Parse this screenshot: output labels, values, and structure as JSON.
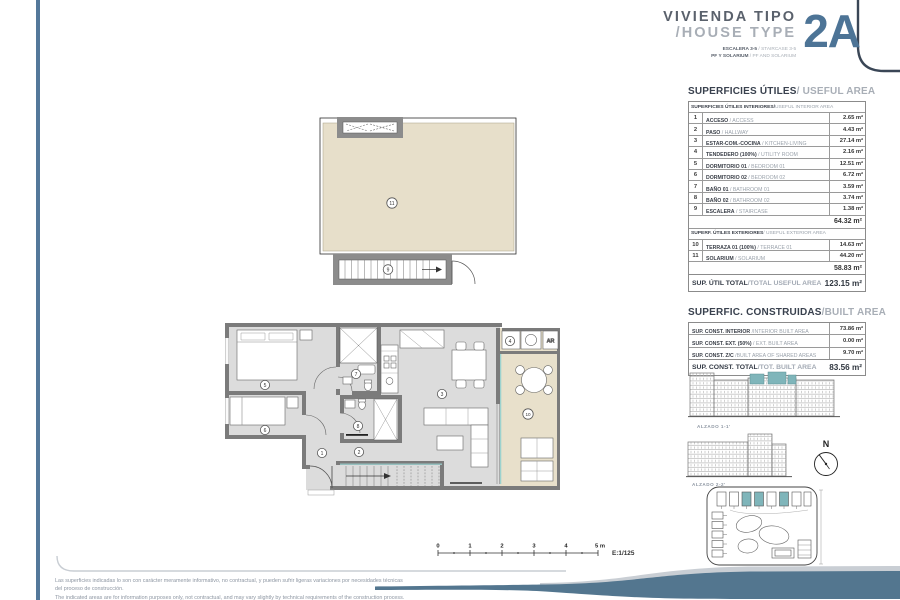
{
  "header": {
    "title_es": "VIVIENDA TIPO",
    "title_en": "/HOUSE TYPE",
    "code": "2A",
    "sub1_es": "ESCALERA 3-5",
    "sub1_en": " / STAIRCASE 3-5",
    "sub2_es": "PF Y SOLARIUM",
    "sub2_en": " / PF AND SOLARIUM"
  },
  "useful": {
    "title_es": "SUPERFICIES ÚTILES",
    "title_en": " / USEFUL AREA",
    "int_header_es": "SUPERFICIES ÚTILES INTERIORES/",
    "int_header_en": " USEFUL INTERIOR AREA",
    "rows": [
      {
        "num": "1",
        "es": "ACCESO",
        "en": " / ACCESS",
        "val": "2.65 m²"
      },
      {
        "num": "2",
        "es": "PASO",
        "en": " / HALLWAY",
        "val": "4.43 m²"
      },
      {
        "num": "3",
        "es": "ESTAR-COM.-COCINA",
        "en": " / KITCHEN-LIVING",
        "val": "27.14 m²"
      },
      {
        "num": "4",
        "es": "TENDEDERO (100%)",
        "en": " / UTILITY ROOM",
        "val": "2.16 m²"
      },
      {
        "num": "5",
        "es": "DORMITORIO 01",
        "en": " / BEDROOM 01",
        "val": "12.51 m²"
      },
      {
        "num": "6",
        "es": "DORMITORIO 02",
        "en": " / BEDROOM 02",
        "val": "6.72 m²"
      },
      {
        "num": "7",
        "es": "BAÑO 01",
        "en": " / BATHROOM 01",
        "val": "3.59 m²"
      },
      {
        "num": "8",
        "es": "BAÑO 02",
        "en": " / BATHROOM 02",
        "val": "3.74 m²"
      },
      {
        "num": "9",
        "es": "ESCALERA",
        "en": " / STAIRCASE",
        "val": "1.38 m²"
      }
    ],
    "int_subtotal": "64.32 m²",
    "ext_header_es": "SUPERF. ÚTILES EXTERIORES",
    "ext_header_en": " / USEFUL EXTERIOR AREA",
    "ext_rows": [
      {
        "num": "10",
        "es": "TERRAZA 01 (100%)",
        "en": " / TERRACE 01",
        "val": "14.63 m²"
      },
      {
        "num": "11",
        "es": "SOLARIUM",
        "en": " / SOLARIUM",
        "val": "44.20 m²"
      }
    ],
    "ext_subtotal": "58.83 m²",
    "total_es": "SUP. ÚTIL TOTAL",
    "total_en": "/TOTAL USEFUL AREA",
    "total_val": "123.15 m²"
  },
  "built": {
    "title_es": "SUPERFIC. CONSTRUIDAS",
    "title_en": " /BUILT AREA",
    "rows": [
      {
        "es": "SUP. CONST. INTERIOR",
        "en": " /INTERIOR BUILT AREA",
        "val": "73.86 m²"
      },
      {
        "es": "SUP. CONST. EXT. (50%)",
        "en": " / EXT. BUILT AREA",
        "val": "0.00 m²"
      },
      {
        "es": "SUP. CONST. Z/C",
        "en": " /BUILT AREA OF SHARED AREAS",
        "val": "9.70 m²"
      }
    ],
    "total_es": "SUP. CONST. TOTAL",
    "total_en": "/TOT. BUILT AREA",
    "total_val": "83.56 m²"
  },
  "elev": {
    "a1": "ALZADO 1-1'",
    "a2": "ALZADO 2-2'",
    "north": "N"
  },
  "plan": {
    "n1": "1",
    "n2": "2",
    "n3": "3",
    "n4": "4",
    "n5": "5",
    "n6": "6",
    "n7": "7",
    "n8": "8",
    "n9": "9",
    "n10": "10",
    "n11": "11",
    "ar": "AR"
  },
  "scale": {
    "t0": "0",
    "t1": "1",
    "t2": "2",
    "t3": "3",
    "t4": "4",
    "t5": "5 m",
    "ratio": "E:1/125"
  },
  "disclaimer": {
    "es1": "Las superficies indicadas lo son con carácter meramente informativo, no contractual, y pueden sufrir ligeras variaciones por necesidades técnicas",
    "es2": "del proceso de construcción.",
    "en": "The indicated areas are for information purposes only, not contractual, and may vary slightly by technical requirements of the construction process."
  },
  "colors": {
    "accent": "#54789a",
    "code_blue": "#4d7496",
    "beige": "#e7dfca",
    "teal": "#7fb5ba",
    "wall_gray": "#7b7b7b",
    "floor_gray": "#dcdcdc",
    "dark_text": "#39414e",
    "light_text": "#a8aeb6"
  }
}
